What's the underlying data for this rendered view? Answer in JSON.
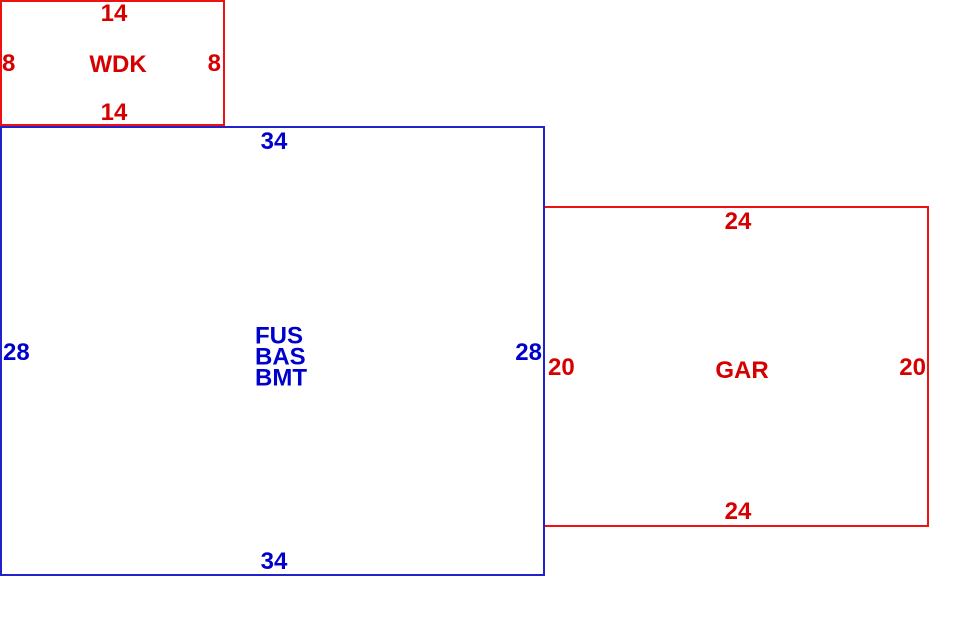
{
  "sketch": {
    "colors": {
      "red_line": "#ee1111",
      "red_text": "#d60000",
      "blue_line": "#2222cc",
      "blue_text": "#0000cc",
      "background": "#ffffff"
    },
    "wdk": {
      "label": "WDK",
      "dims": {
        "top": "14",
        "bottom": "14",
        "left": "8",
        "right": "8"
      }
    },
    "fus": {
      "label_lines": {
        "l1": "FUS",
        "l2": "BAS",
        "l3": "BMT"
      },
      "dims": {
        "top": "34",
        "bottom": "34",
        "left": "28",
        "right": "28"
      }
    },
    "gar": {
      "label": "GAR",
      "dims": {
        "top": "24",
        "bottom": "24",
        "left": "20",
        "right": "20"
      }
    }
  }
}
